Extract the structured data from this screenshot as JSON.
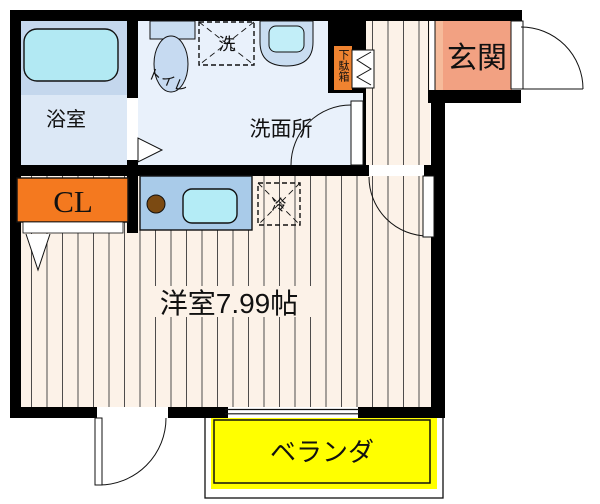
{
  "plan": {
    "title": "floor-plan",
    "rooms": {
      "bathroom": {
        "label": "浴室"
      },
      "toilet": {
        "label": "トイレ"
      },
      "washroom": {
        "label": "洗面所"
      },
      "entrance": {
        "label": "玄関"
      },
      "closet": {
        "label": "CL"
      },
      "main_room": {
        "label": "洋室7.99帖"
      },
      "veranda": {
        "label": "ベランダ"
      }
    },
    "fixtures": {
      "washer_box": {
        "label": "洗"
      },
      "fridge_box": {
        "label": "冷"
      },
      "shoe_cabinet": {
        "label": "下駄箱"
      }
    },
    "colors": {
      "wall": "#000000",
      "floor": "#fcf2e8",
      "floor_line": "#3a3a3a",
      "washroom_bg": "#e9f1fb",
      "bathroom_bg": "#dce8f6",
      "tub_band": "#c4d7ed",
      "tub_fill": "#b2e9f3",
      "fixture_blue": "#c9ddf1",
      "basin_inner": "#c2eef8",
      "counter_fill": "#a9cbe9",
      "sink_fill": "#b4ecf6",
      "burner_fill": "#7b4a12",
      "closet_fill": "#f4791f",
      "entrance_fill": "#f2a182",
      "entrance_step": "#f6bb9b",
      "shoe_fill": "#ef8330",
      "veranda_fill": "#ffff00"
    }
  }
}
